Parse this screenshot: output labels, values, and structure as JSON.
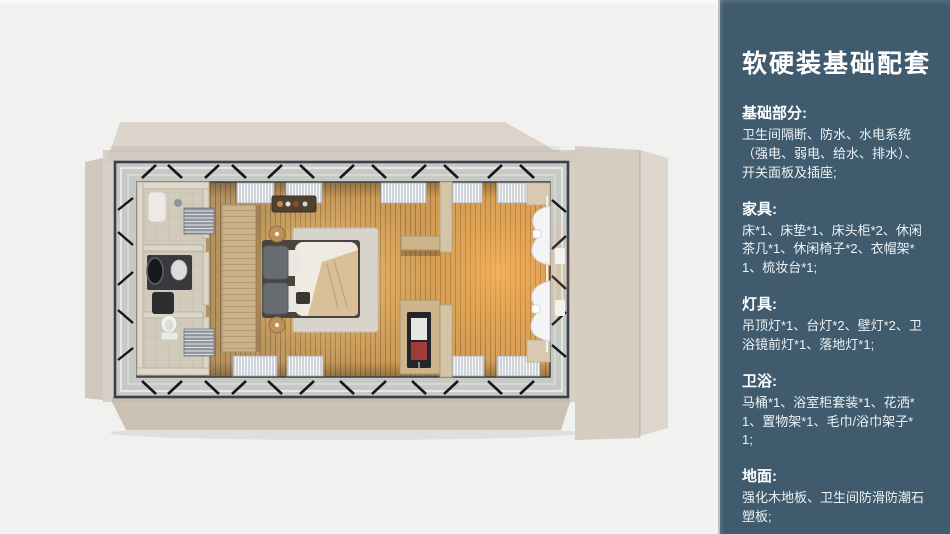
{
  "colors": {
    "background": "#f1f1f0",
    "panel_bg": "#3f5b6d",
    "panel_text": "#ffffff",
    "shell_beige": "#d8cfc6",
    "frame_dark": "#39404e",
    "wood_floor_warm": "#c89a5c",
    "glow_warm": "#ffbe6e"
  },
  "panel": {
    "title": "软硬装基础配套",
    "sections": [
      {
        "heading": "基础部分:",
        "body": "卫生间隔断、防水、水电系统（强电、弱电、给水、排水）、开关面板及插座;"
      },
      {
        "heading": "家具:",
        "body": "床*1、床垫*1、床头柜*2、休闲茶几*1、休闲椅子*2、衣帽架*1、梳妆台*1;"
      },
      {
        "heading": "灯具:",
        "body": "吊顶灯*1、台灯*2、壁灯*2、卫浴镜前灯*1、落地灯*1;"
      },
      {
        "heading": "卫浴:",
        "body": "马桶*1、浴室柜套装*1、花洒*1、置物架*1、毛巾/浴巾架子*1;"
      },
      {
        "heading": "地面:",
        "body": "强化木地板、卫生间防滑防潮石塑板;"
      }
    ]
  },
  "floorplan": {
    "view": "top-down 3D render of container guest room",
    "elements": [
      "container-shell",
      "open-roof-flaps",
      "steel-frame",
      "bathroom",
      "shower",
      "vanity-mirror",
      "toilet",
      "towel-radiators",
      "headboard-partition",
      "double-bed",
      "pillows",
      "throw-blanket",
      "area-rug",
      "bedside-stools",
      "hanging-bottle-shelf",
      "wall-shelf",
      "mini-fridge",
      "divider-wall",
      "window-blinds",
      "sheer-curtains",
      "wood-slat-floor"
    ]
  }
}
